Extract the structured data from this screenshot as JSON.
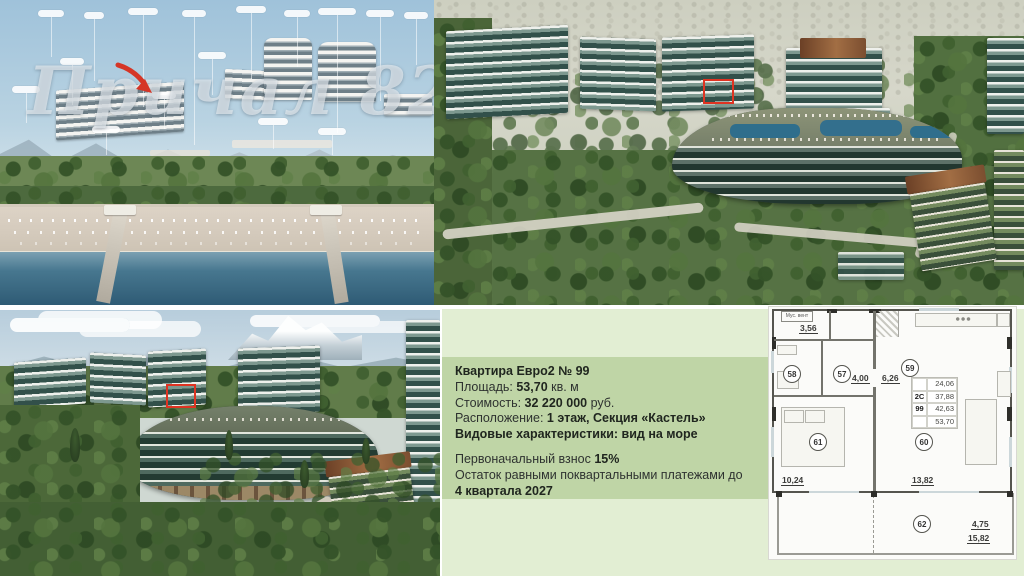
{
  "slide": {
    "watermark_text": "Причал 82",
    "accent_red": "#df3322",
    "panel_green": "#bfd5a6",
    "panel_green_light": "#e2eed3"
  },
  "apartment": {
    "title": "Квартира Евро2 № 99",
    "area_label": "Площадь: ",
    "area_value": "53,70",
    "area_suffix": " кв. м",
    "price_label": "Стоимость: ",
    "price_value": "32 220 000",
    "price_suffix": " руб.",
    "location_label": "Расположение: ",
    "location_value": "1 этаж, Секция «Кастель»",
    "view_line": "Видовые характеристики: вид на море",
    "downpayment_label": "Первоначальный взнос ",
    "downpayment_value": "15%",
    "installment_line": "Остаток равными поквартальными платежами до",
    "installment_deadline": "4 квартала 2027"
  },
  "floor_plan": {
    "vent_label": "Мус. вент",
    "info_table": {
      "type_code": "2С",
      "apt_number": "99",
      "total_values": [
        "24,06",
        "37,88",
        "42,63",
        "53,70"
      ]
    },
    "rooms": [
      {
        "num": "58"
      },
      {
        "num": "57"
      },
      {
        "num": "59"
      },
      {
        "num": "61"
      },
      {
        "num": "60"
      },
      {
        "num": "62"
      }
    ],
    "areas": {
      "utility": "3,56",
      "hall": "4,00",
      "corridor": "6,26",
      "bedroom": "10,24",
      "living": "13,82",
      "terrace_small": "4,75",
      "terrace": "15,82"
    }
  }
}
